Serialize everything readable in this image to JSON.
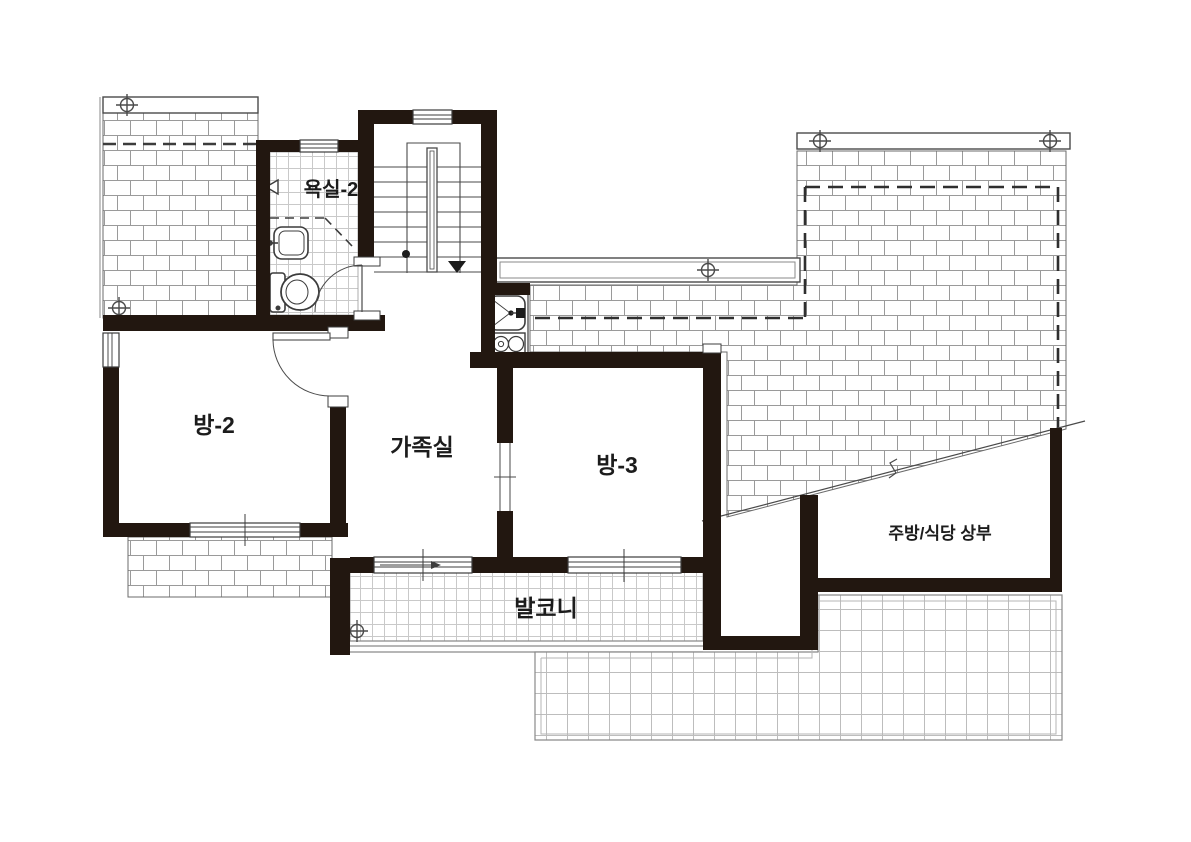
{
  "title": "second-floor-plan",
  "labels": {
    "bathroom2": "욕실-2",
    "room2": "방-2",
    "family_room": "가족실",
    "room3": "방-3",
    "balcony": "발코니",
    "kitchen_dining_upper": "주방/식당 상부"
  },
  "colors": {
    "wall": "#221710",
    "line": "#3c3c3c",
    "grid_light": "#c4c4c4",
    "brick_mortar": "#9a9a9a",
    "background": "#ffffff"
  },
  "symbols": {
    "ridge_vent_marker": "circle-cross survey marker",
    "stair_direction": "down-arrow",
    "roof_hatch": "brick running-bond",
    "hidden_lines": "dashed",
    "slope_break": "diagonal line with break zigzag"
  }
}
